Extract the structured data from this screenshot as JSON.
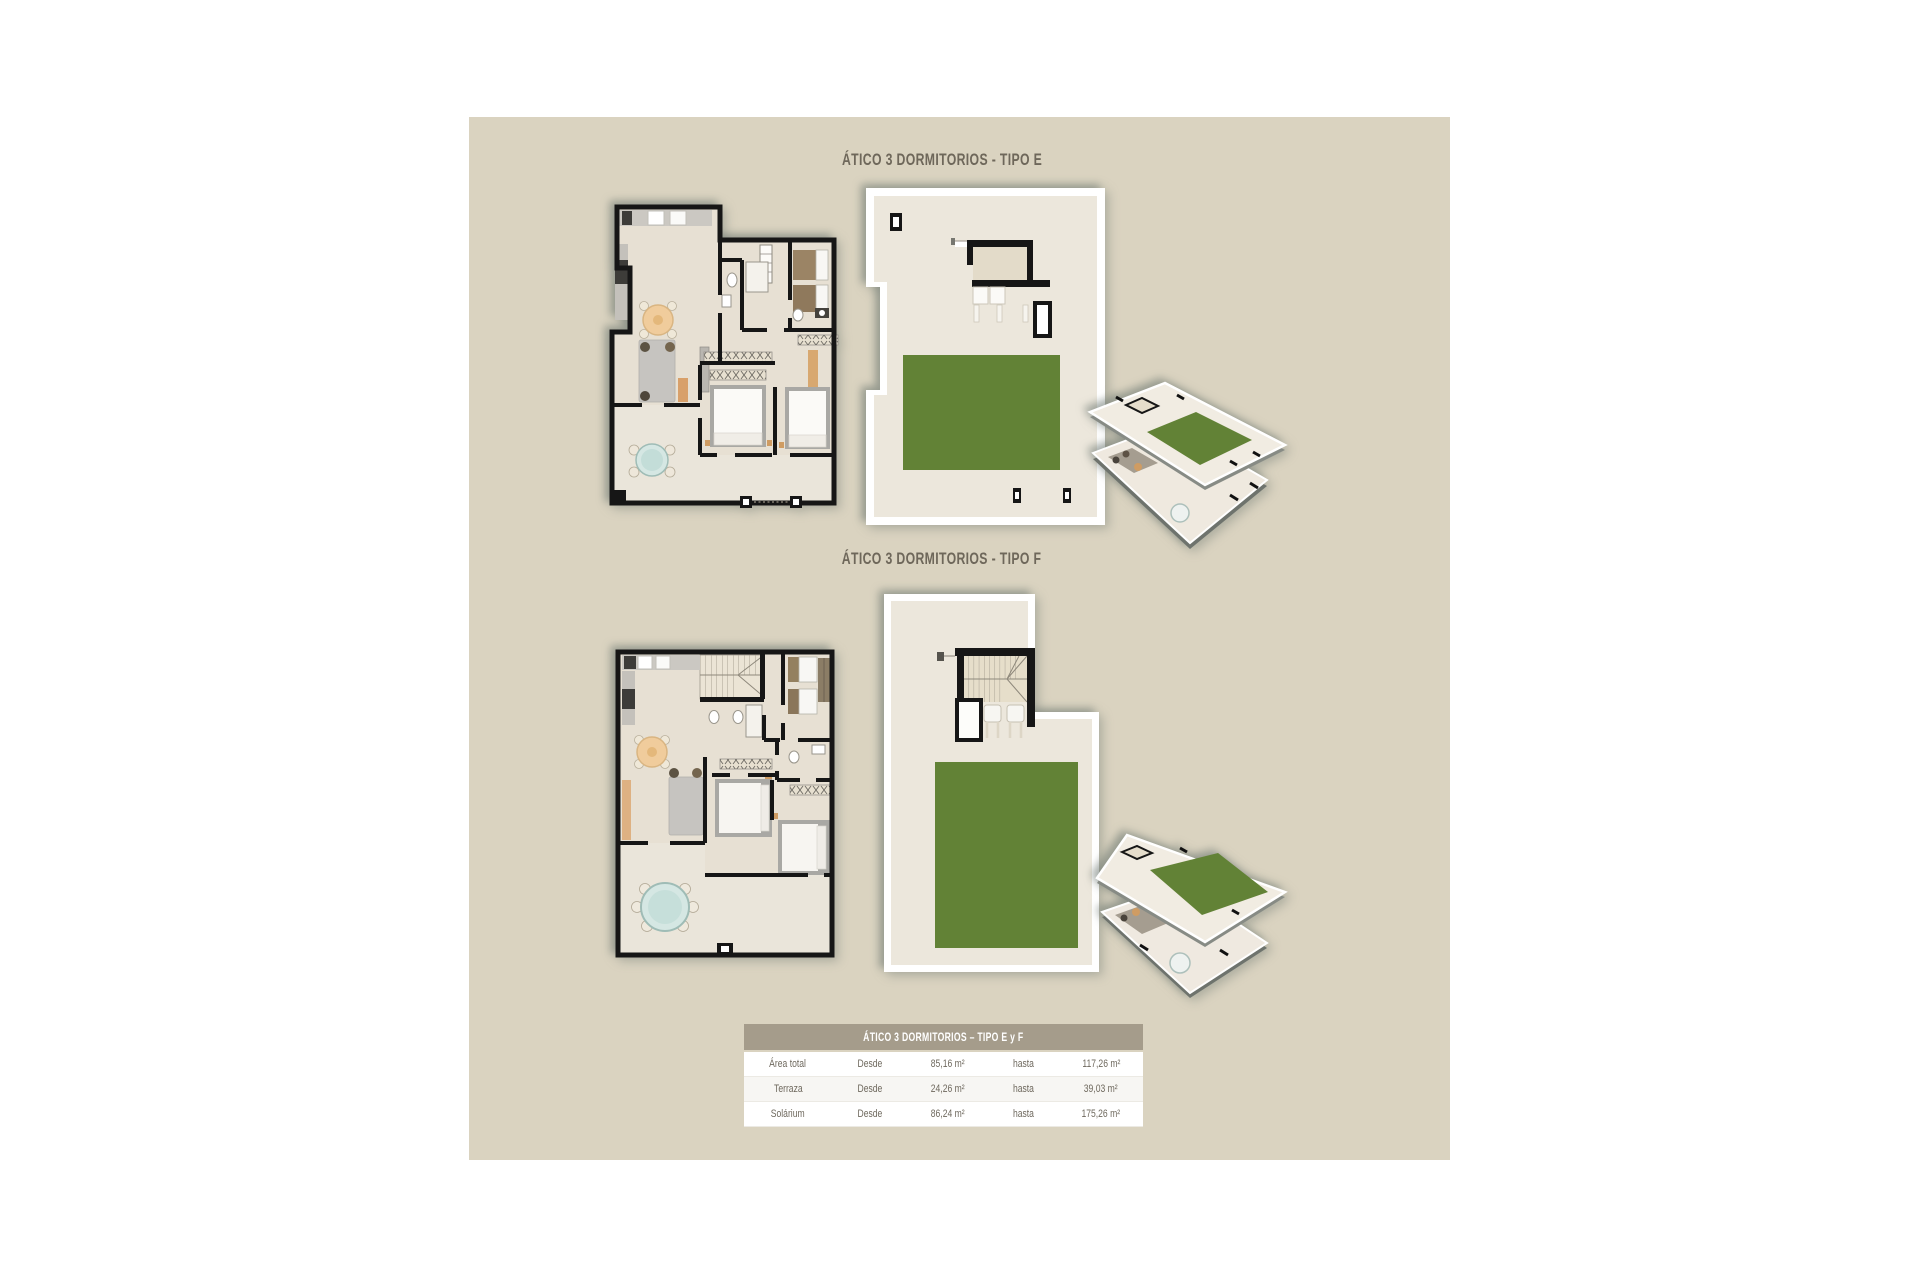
{
  "sections": {
    "tipo_e": {
      "title": "ÁTICO 3 DORMITORIOS - TIPO E"
    },
    "tipo_f": {
      "title": "ÁTICO 3 DORMITORIOS - TIPO F"
    }
  },
  "table": {
    "title": "ÁTICO 3 DORMITORIOS – TIPO E y F",
    "rows": [
      {
        "label": "Área total",
        "from_label": "Desde",
        "from_value": "85,16 m²",
        "to_label": "hasta",
        "to_value": "117,26 m²"
      },
      {
        "label": "Terraza",
        "from_label": "Desde",
        "from_value": "24,26 m²",
        "to_label": "hasta",
        "to_value": "39,03 m²"
      },
      {
        "label": "Solárium",
        "from_label": "Desde",
        "from_value": "86,24 m²",
        "to_label": "hasta",
        "to_value": "175,26 m²"
      }
    ]
  },
  "colors": {
    "panel-bg": "#dad3c0",
    "title-text": "#6e675a",
    "wall": "#161616",
    "floor": "#e7e0d3",
    "floor-light": "#eae5da",
    "solarium-floor": "#ece7dc",
    "lawn": "#628236",
    "table-header-bg": "#a59c8b",
    "table-text": "#6e685d",
    "counter": "#cbc8c2",
    "sofa": "#c6c4c0",
    "wood-table": "#f0cc9c",
    "glass-table": "#d5e7e3",
    "bed-rim": "#a9a8a4",
    "dark-unit": "#3d3c39",
    "headboard": "#94805f"
  }
}
